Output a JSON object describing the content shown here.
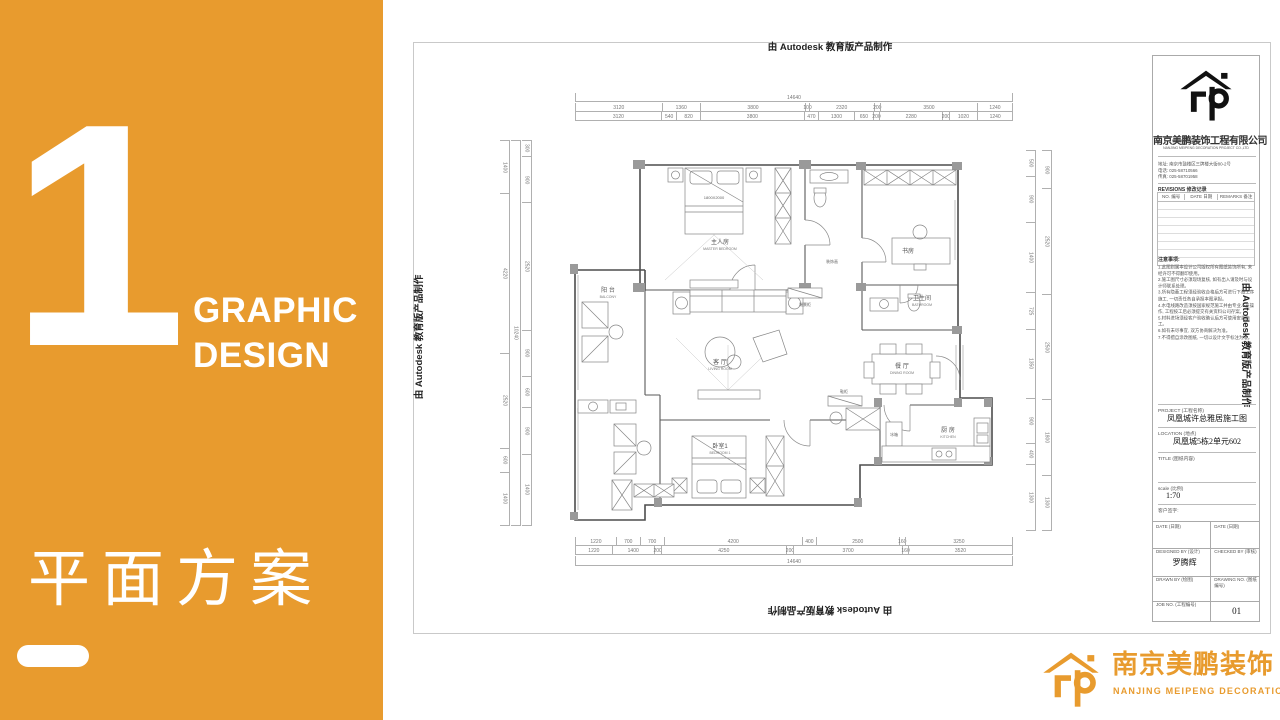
{
  "slide": {
    "number": "1",
    "heading1": "GRAPHIC",
    "heading2": "DESIGN",
    "cn_title": "平面方案",
    "accent": "#E89B2E"
  },
  "stamps": {
    "autodesk": "由 Autodesk 教育版产品制作"
  },
  "brand": {
    "cn": "南京美鹏装饰",
    "en": "NANJING MEIPENG DECORATION"
  },
  "titleblock": {
    "company_cn": "南京美鹏装饰工程有限公司",
    "company_en": "NANJING MEIPENG DECORATION PROJECT CO.,LTD",
    "address": "地址: 南京市鼓楼区三牌楼大街80-2号",
    "tel": "电话: 025-58710566",
    "fax": "传真: 025-58701958",
    "revisions_label": "REVISIONS 修改记录",
    "col_no": "NO. 编号",
    "col_date": "DATE 日期",
    "col_remarks": "REMARKS 备注",
    "notes_title": "注意事项:",
    "notes": [
      "1.此图则属本设计公司版权所有图纸装饰所有, 未经许可不得翻印使用。",
      "2.施工图尺寸必须现场复核, 如有出入请及时与设计师联系处理。",
      "3.所有隐蔽工程须经验收合格后方可进行下道工序施工, 一切责任各自承担本图承担。",
      "4.水电线路改造须按国家规范施工并由专业人员操作, 工程按工后必须提交有关资料公司存案。",
      "5.材料进场须经客户验收确认后方可使用安装施工。",
      "6.如有未尽事宜, 双方协商解决为准。",
      "7.不得擅自涂改图纸, 一切以设计文字标注为准。"
    ],
    "project_label": "PROJECT (工程名称)",
    "project_value": "凤凰城许总雅居施工图",
    "location_label": "LOCATION (地点)",
    "location_value": "凤凰城5栋2单元602",
    "title_label": "TITLE (图纸内容)",
    "scale_label": "scale (比例)",
    "scale_value": "1:70",
    "client_sign": "客户签字:",
    "date_label": "DATE (日期)",
    "designed_label": "DESIGNED BY (设计)",
    "designed_value": "罗腾辉",
    "checked_label": "CHECKED BY (审核)",
    "drawn_label": "DRAWN BY (绘图)",
    "drawing_no_label": "DRAWING NO. (图纸编号)",
    "job_no_label": "JOB NO. (工程编号)",
    "drawing_no_value": "01"
  },
  "plan": {
    "rooms": {
      "master": {
        "cn": "主人房",
        "en": "MASTER BEDROOM"
      },
      "balcony": {
        "cn": "阳 台",
        "en": "BALCONY"
      },
      "living": {
        "cn": "客 厅",
        "en": "LIVING ROOM"
      },
      "study": {
        "cn": "书房",
        "en": ""
      },
      "bathroom": {
        "cn": "卫生间",
        "en": "BATHROOM"
      },
      "dining": {
        "cn": "餐 厅",
        "en": "DINING ROOM"
      },
      "kitchen": {
        "cn": "厨 房",
        "en": "KITCHEN"
      },
      "bedroom1": {
        "cn": "卧室1",
        "en": "BEDROOM 1"
      },
      "endcab": {
        "cn": "端景柜"
      },
      "art": {
        "cn": "装饰画"
      },
      "shoe": {
        "cn": "鞋柜"
      },
      "fridge": {
        "cn": "冰箱"
      }
    },
    "bed_size": "1800X2000",
    "dims": {
      "top_total": [
        "14640"
      ],
      "top1": [
        "3120",
        "1360",
        "3800",
        "100",
        "2320",
        "200",
        "3500",
        "1240"
      ],
      "top2": [
        "3120",
        "540",
        "820",
        "3800",
        "470",
        "1300",
        "650",
        "200",
        "2280",
        "200",
        "1020",
        "1240"
      ],
      "bottom1": [
        "1220",
        "700",
        "700",
        "4200",
        "400",
        "2500",
        "160",
        "3250"
      ],
      "bottom2": [
        "1220",
        "1400",
        "200",
        "4250",
        "200",
        "3700",
        "160",
        "3520"
      ],
      "bottom_total": [
        "14640"
      ],
      "left_outer": [
        "1400",
        "4220",
        "2520",
        "600",
        "1400"
      ],
      "left_total": [
        "10240"
      ],
      "left_inner": [
        "300",
        "900",
        "2520",
        "900",
        "600",
        "900",
        "1400"
      ],
      "right_inner": [
        "500",
        "900",
        "1400",
        "725",
        "1350",
        "900",
        "400",
        "1300"
      ],
      "right_outer": [
        "900",
        "2520",
        "2500",
        "1800",
        "1300"
      ]
    }
  }
}
